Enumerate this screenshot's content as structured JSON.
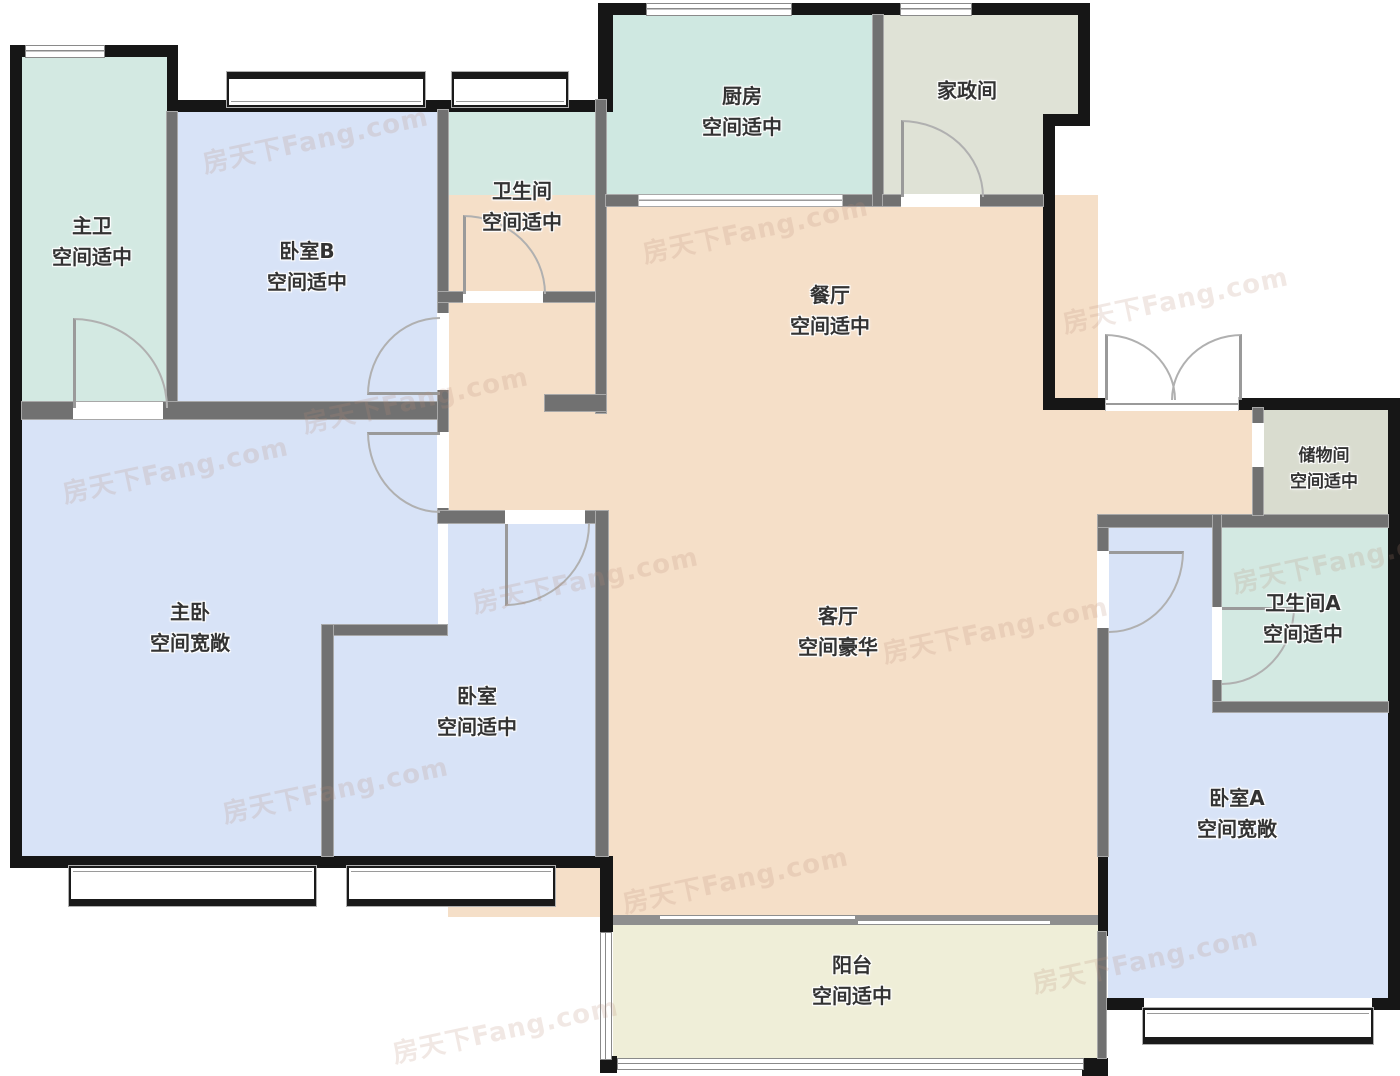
{
  "watermark": {
    "text": "房天下Fang.com"
  },
  "rooms": {
    "zhuwei": {
      "name": "主卫",
      "note": "空间适中"
    },
    "woshi_b": {
      "name": "卧室B",
      "note": "空间适中"
    },
    "weishengjian": {
      "name": "卫生间",
      "note": "空间适中"
    },
    "chufang": {
      "name": "厨房",
      "note": "空间适中"
    },
    "jiazhengjian": {
      "name": "家政间"
    },
    "canting": {
      "name": "餐厅",
      "note": "空间适中"
    },
    "zhuwo": {
      "name": "主卧",
      "note": "空间宽敞"
    },
    "woshi": {
      "name": "卧室",
      "note": "空间适中"
    },
    "keting": {
      "name": "客厅",
      "note": "空间豪华"
    },
    "chuwujian": {
      "name": "储物间",
      "note": "空间适中"
    },
    "weishengjian_a": {
      "name": "卫生间A",
      "note": "空间适中"
    },
    "woshi_a": {
      "name": "卧室A",
      "note": "空间宽敞"
    },
    "yangtai": {
      "name": "阳台",
      "note": "空间适中"
    }
  },
  "colors": {
    "bath_teal": "#d3e9e2",
    "kitchen_teal": "#cfe8e1",
    "bedroom_blue": "#d8e3f7",
    "service_gray": "#dfe2d6",
    "storage_gray": "#d9dccf",
    "living_peach": "#f5dfc8",
    "balcony_cream": "#efeed8",
    "wall_black": "#161616",
    "wall_gray": "#717171"
  }
}
